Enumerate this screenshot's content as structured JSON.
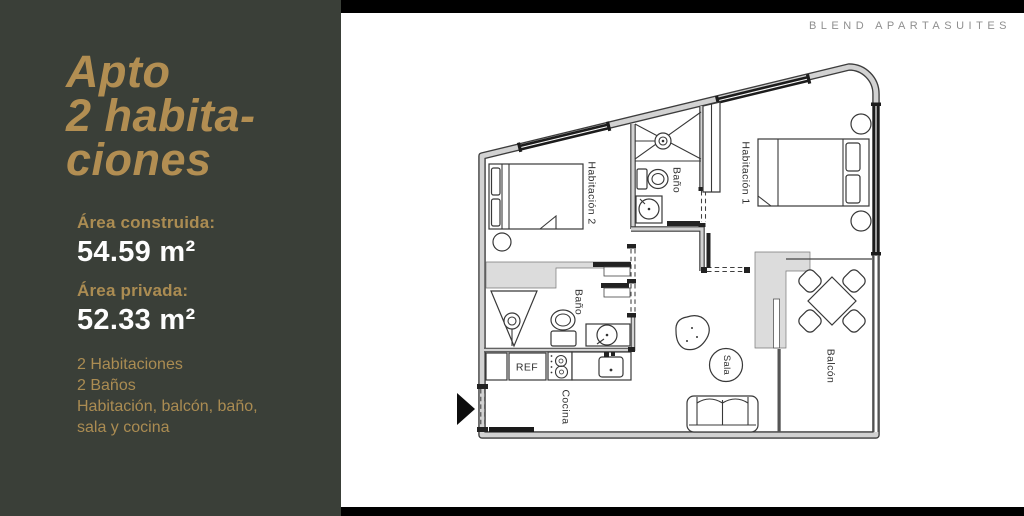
{
  "brand": "BLEND APARTASUITES",
  "panel": {
    "title_lines": [
      "Apto",
      "2 habita-",
      "ciones"
    ],
    "area_built_label": "Área construida:",
    "area_built_value": "54.59 m²",
    "area_private_label": "Área privada:",
    "area_private_value": "52.33 m²",
    "features": [
      "2 Habitaciones",
      "2 Baños",
      "Habitación, balcón, baño,",
      "sala y cocina"
    ]
  },
  "floorplan": {
    "labels": {
      "bedroom2": "Habitación 2",
      "bath_top": "Baño",
      "bedroom1": "Habitación 1",
      "bath_bottom": "Baño",
      "fridge": "REF",
      "kitchen": "Cocina",
      "living": "Sala",
      "balcony": "Balcón"
    }
  },
  "colors": {
    "panel_bg": "#3a3f38",
    "gold_title": "#b28e52",
    "gold_text": "#ab8c52",
    "value_white": "#fdfdfd",
    "brand_gray": "#8f8f8f",
    "bar_black": "#000000"
  }
}
